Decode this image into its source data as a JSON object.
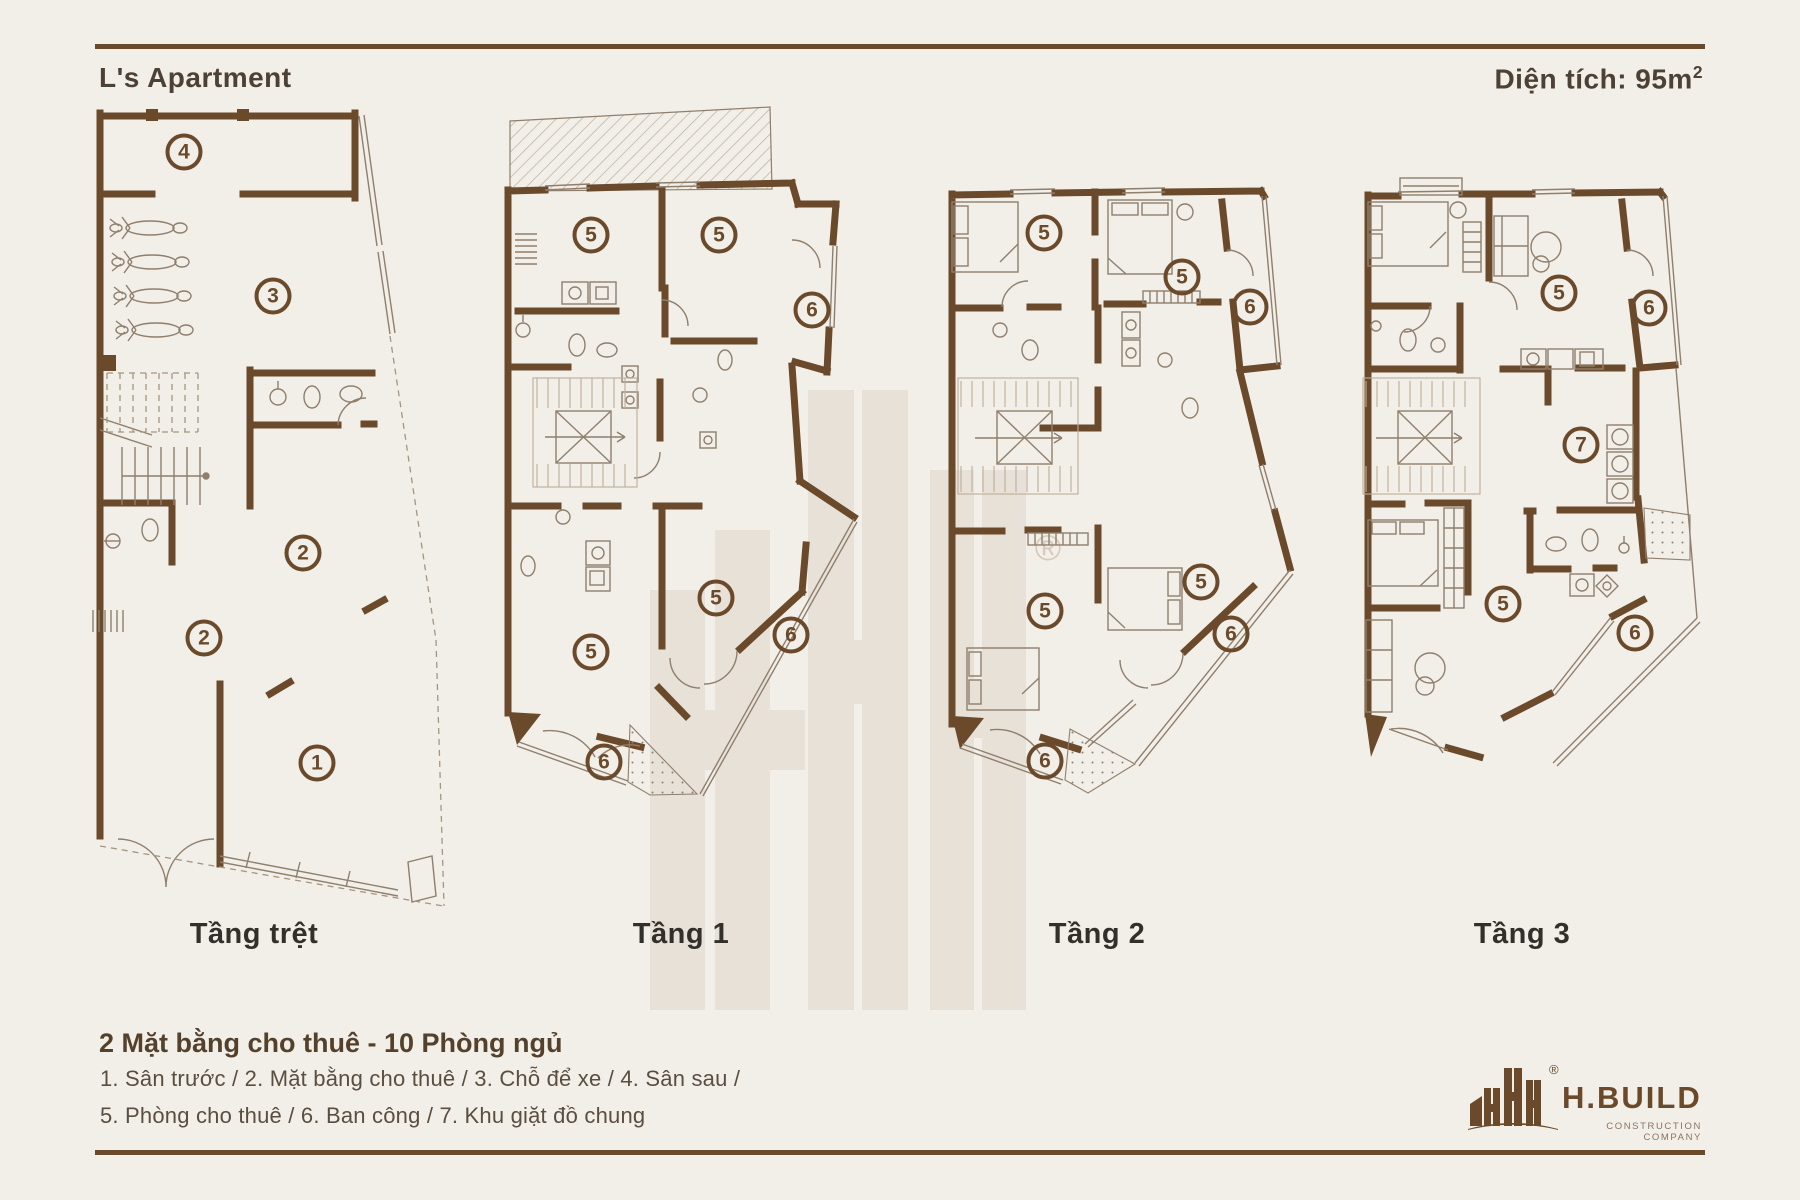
{
  "header": {
    "title": "L's Apartment",
    "area_label": "Diện tích: 95m",
    "area_sup": "2"
  },
  "plans": [
    {
      "id": "ground",
      "label": "Tầng trệt",
      "label_x": 254,
      "markers": [
        {
          "n": "4",
          "x": 184,
          "y": 152
        },
        {
          "n": "3",
          "x": 273,
          "y": 296
        },
        {
          "n": "2",
          "x": 303,
          "y": 553
        },
        {
          "n": "2",
          "x": 204,
          "y": 638
        },
        {
          "n": "1",
          "x": 317,
          "y": 763
        }
      ]
    },
    {
      "id": "floor1",
      "label": "Tầng 1",
      "label_x": 681,
      "markers": [
        {
          "n": "5",
          "x": 591,
          "y": 235
        },
        {
          "n": "5",
          "x": 719,
          "y": 235
        },
        {
          "n": "6",
          "x": 812,
          "y": 310
        },
        {
          "n": "5",
          "x": 716,
          "y": 598
        },
        {
          "n": "6",
          "x": 791,
          "y": 635
        },
        {
          "n": "5",
          "x": 591,
          "y": 652
        },
        {
          "n": "6",
          "x": 604,
          "y": 762
        }
      ]
    },
    {
      "id": "floor2",
      "label": "Tầng 2",
      "label_x": 1097,
      "markers": [
        {
          "n": "5",
          "x": 1044,
          "y": 233
        },
        {
          "n": "5",
          "x": 1182,
          "y": 277
        },
        {
          "n": "6",
          "x": 1250,
          "y": 307
        },
        {
          "n": "5",
          "x": 1201,
          "y": 582
        },
        {
          "n": "6",
          "x": 1231,
          "y": 634
        },
        {
          "n": "5",
          "x": 1045,
          "y": 611
        },
        {
          "n": "6",
          "x": 1045,
          "y": 761
        }
      ]
    },
    {
      "id": "floor3",
      "label": "Tầng 3",
      "label_x": 1522,
      "markers": [
        {
          "n": "5",
          "x": 1559,
          "y": 293
        },
        {
          "n": "6",
          "x": 1649,
          "y": 308
        },
        {
          "n": "7",
          "x": 1581,
          "y": 445
        },
        {
          "n": "5",
          "x": 1503,
          "y": 604
        },
        {
          "n": "6",
          "x": 1635,
          "y": 633
        }
      ]
    }
  ],
  "summary": {
    "heading": "2 Mặt bằng cho thuê - 10 Phòng ngủ",
    "legend_line1": "1. Sân trước / 2. Mặt bằng cho thuê / 3. Chỗ để xe / 4. Sân sau /",
    "legend_line2": "5. Phòng cho thuê / 6. Ban công / 7. Khu giặt đồ chung"
  },
  "logo": {
    "brand": "H.BUILD",
    "tagline": "CONSTRUCTION COMPANY",
    "registered": "®"
  },
  "watermark": {
    "registered": "®"
  },
  "colors": {
    "background": "#f2efe9",
    "wall_brown": "#6b4a2b",
    "title_brown": "#4c4134",
    "label_dark": "#33302c",
    "legend_brown": "#5a4e40"
  }
}
